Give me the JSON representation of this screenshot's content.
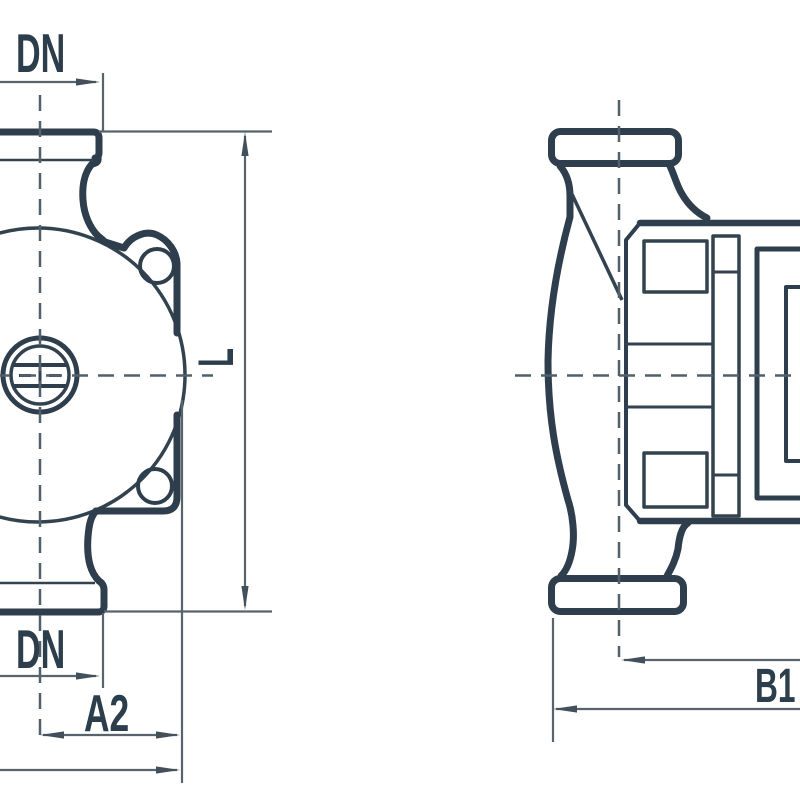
{
  "drawing": {
    "kind": "technical dimensional drawing, circulation pump, two orthographic views",
    "labels": {
      "dn_top": "DN",
      "dn_bottom": "DN",
      "length": "L",
      "a2": "A2",
      "b1": "B1"
    },
    "colors": {
      "outline": "#2e3e4c",
      "dimension_line": "#57646e",
      "centerline": "#51606b",
      "background": "#ffffff"
    }
  }
}
